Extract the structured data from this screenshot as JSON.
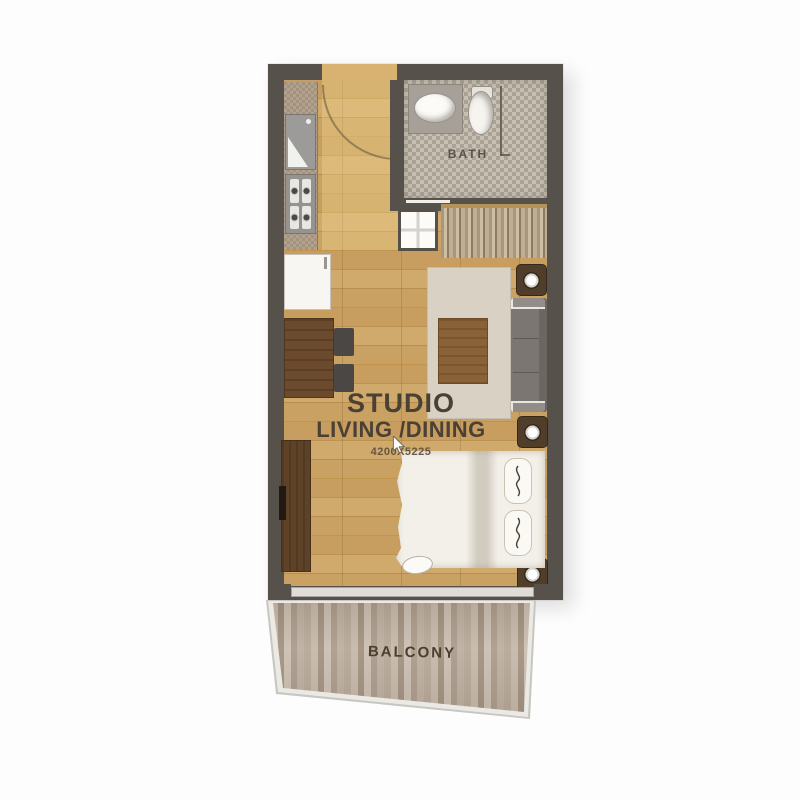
{
  "labels": {
    "unit_title": "STUDIO",
    "unit_subtitle": "LIVING /DINING",
    "unit_dimensions": "4200X5225",
    "bath": "BATH",
    "balcony": "BALCONY"
  },
  "colors": {
    "wall": "#57514b",
    "floor": "#c79e60",
    "tile-a": "#c6bfb4",
    "tile-b": "#aba294",
    "rug": "#d8d1c4",
    "sofa": "#7b7672",
    "table": "#8b6237",
    "wood-dark": "#6b4a2d",
    "cabinet": "#5e4227",
    "bed": "#f3f0e9",
    "plank": "#b7a898",
    "text": "#4a4033"
  }
}
